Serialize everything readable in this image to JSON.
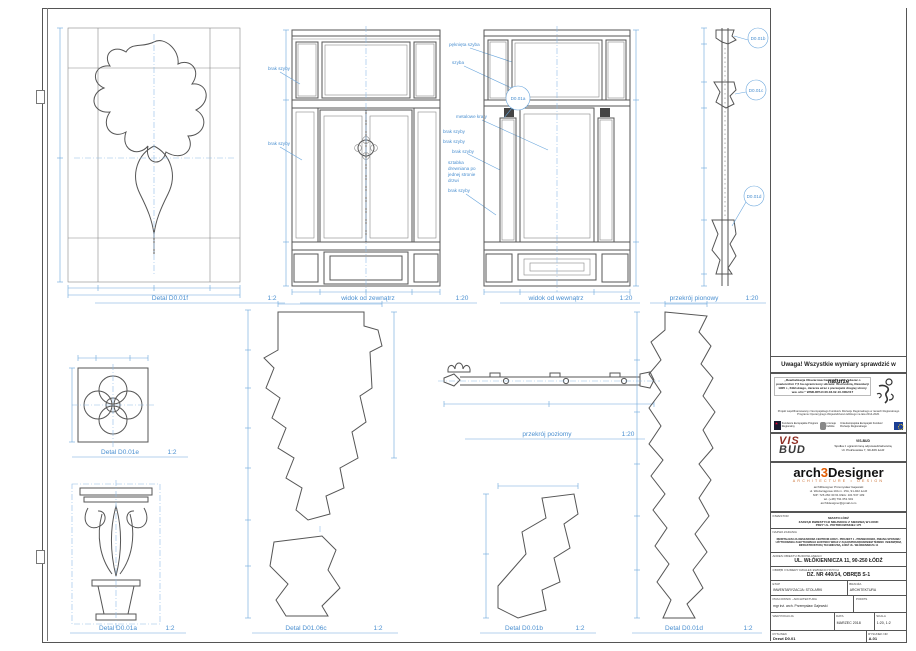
{
  "views": {
    "detail_f": {
      "label": "Detal D0.01f",
      "scale": "1:2"
    },
    "view_ext": {
      "label": "widok od zewnątrz",
      "scale": "1:20"
    },
    "view_int": {
      "label": "widok od wewnątrz",
      "scale": "1:20"
    },
    "section_v": {
      "label": "przekrój pionowy",
      "scale": "1:20"
    },
    "detail_e": {
      "label": "Detal D0.01e",
      "scale": "1:2"
    },
    "detail_a": {
      "label": "Detal D0.01a",
      "scale": "1:2"
    },
    "detail_c": {
      "label": "Detal D01.06c",
      "scale": "1:2"
    },
    "section_h": {
      "label": "przekrój poziomy",
      "scale": "1:20"
    },
    "detail_b": {
      "label": "Detal D0.01b",
      "scale": "1:2"
    },
    "detail_d": {
      "label": "Detal D0.01d",
      "scale": "1:2"
    }
  },
  "annotations": {
    "broken_glass": "pęknięta szyba",
    "glass": "szyba",
    "metal_grilles": "metalowe kraty",
    "no_glass_1": "brak szyby",
    "no_glass_2": "brak szyby",
    "no_glass_3": "brak szyby",
    "no_glass_4": "brak szyby",
    "no_glass_5": "brak szyby",
    "no_glass_6": "brak szyby",
    "wood_bar": "sztabka\ndrewniana po\njednej stronie\ndrzwi",
    "callout_a": "D0.01a",
    "callout_b": "D0.01b",
    "callout_c": "D0.01c",
    "callout_d": "D0.01d"
  },
  "titleblock": {
    "note": "Uwaga! Wszystkie wymiary sprawdzić w naturze",
    "eu": {
      "quote": "„Rewitalizacja Obszarowa Centrum Łodzi - obszar o powierzchni 7,5 ha ograniczony ulicami: Wschodnią, Rewolucji 1905 r., Kilińskiego, Jaracza wraz z pierzejami drugiej strony ww. ulic.\"",
      "wnd": "WND-RPLD.06.03.02-10-0002/17",
      "cofinance": "Projekt współfinansowany z Europejskiego Funduszu Rozwoju Regionalnego w ramach Regionalnego Programu Operacyjnego Województwa Łódzkiego na lata 2014-2020.",
      "logo_fe": "Fundusze Europejskie Program Regionalny",
      "logo_lodzkie": "promuje łódzkie",
      "logo_eu": "Unia Europejska Europejski Fundusz Rozwoju Regionalnego"
    },
    "visbud": {
      "vis": "VIS",
      "bud": "BUD",
      "name": "VIS-BUD",
      "line2": "Spółka z ograniczoną odpowiedzialnością",
      "line3": "Ul. Piotrkowska 7, 90-406 Łódź"
    },
    "arch3d": {
      "logo_pre": "arch",
      "logo_three": "3",
      "logo_post": "Designer",
      "tagline": "ARCHITECTURE • DESIGN",
      "contact": "arch3Designer   Przemysław Gajewski\nul. Wodociągowa 10A m. 15A,  91-022 Łódź\nNIP: 726 260 30 61   REG: 101 537 109\ntel. (+48) 791 051 901\narch3designer@gmail.com"
    },
    "table": {
      "inwestor_label": "INWESTOR",
      "inwestor_value": "MIASTO ŁÓDŹ\nZARZĄD INWESTYCJI MIEJSKICH Z SIEDZIBĄ W ŁODZI\nPRZY UL. PIOTRKOWSKIEJ 175",
      "nazwa_label": "NAZWA ZADANIA",
      "nazwa_value": "REWITALIZACJA OBSZAROWA CENTRUM ŁODZI - PROJEKT 1 - PRZEBUDOWA, ZMIANA SPOSOBU UŻYTKOWANIA ZABYTKOWEGO BUDYNKU WRAZ Z ZAGOSPODAROWANIEM TERENU I NIEZBĘDNĄ INFRASTRUKTURĄ TECHNICZNĄ, ŁÓDŹ UL. WŁÓKIENNICZA 11",
      "adres_label": "ADRES OBIEKTU BUDOWLANEGO",
      "adres_value": "UL. WŁÓKIENNICZA 11, 90-250 ŁÓDŹ",
      "obreb_label": "OBRĘB I NUMERY DZIAŁEK EWIDENCYJNYCH",
      "obreb_value": "DZ. NR 440/14, OBRĘB S-1",
      "etap_label": "ETAP",
      "etap_value": "INWENTARYZACJA: STOLARKI",
      "branza_label": "BRANŻA",
      "branza_value": "ARCHITEKTURA",
      "pracownik_label": "PRACOWNIK - ARCHITEKTURA",
      "pracownik_value": "mgr inż. arch. Przemysław Gajewski",
      "podpis_label": "PODPIS",
      "podpis_value": "",
      "weryfikacja_label": "WERYFIKACJA",
      "weryfikacja_value": "",
      "data_label": "DATA",
      "data_value": "MARZEC 2018",
      "skala_label": "SKALA",
      "skala_value": "1:20, 1:2",
      "rysunek_label": "RYSUNEK",
      "rysunek_value": "Drzwi D0.01",
      "nr_label": "RYSUNEK NR",
      "nr_value": "A.01"
    }
  }
}
